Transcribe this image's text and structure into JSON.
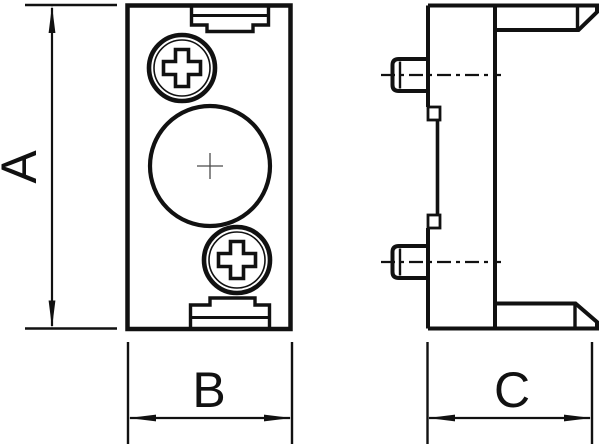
{
  "drawing": {
    "labels": {
      "height": "A",
      "width": "B",
      "depth": "C"
    }
  },
  "colors": {
    "line": "#111111",
    "background": "#ffffff",
    "center_mark": "#4a4a4a"
  }
}
